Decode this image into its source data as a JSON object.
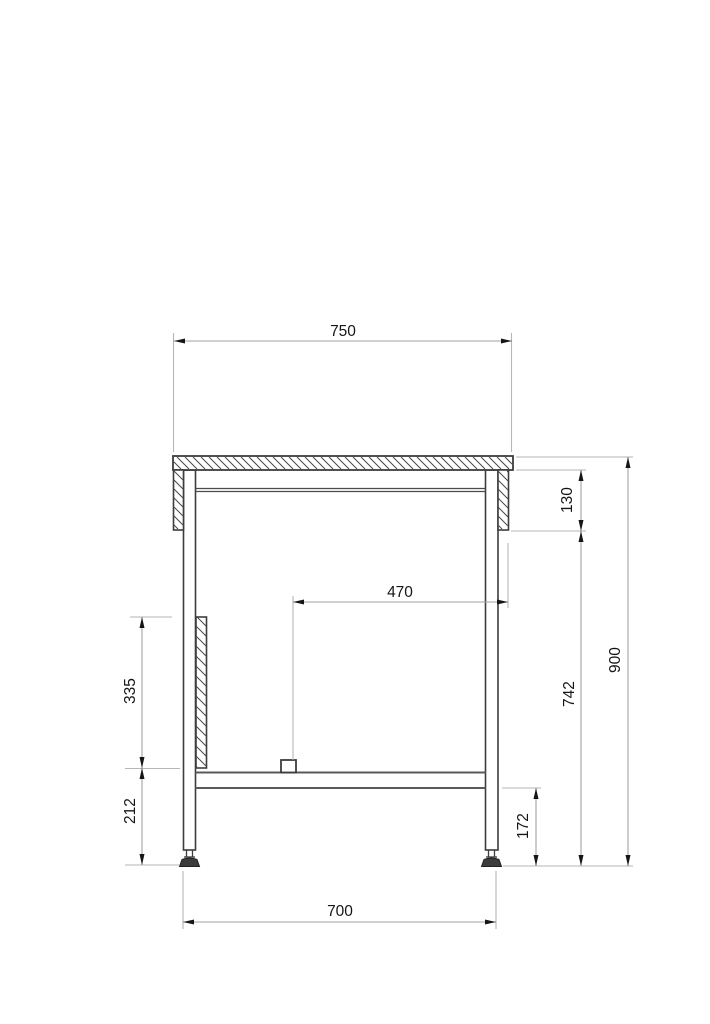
{
  "dimensions": {
    "top_width": {
      "value": "750"
    },
    "apron_height": {
      "value": "130"
    },
    "shelf_stop_span": {
      "value": "470"
    },
    "side_panel_height": {
      "value": "335"
    },
    "lower_leg_height": {
      "value": "212"
    },
    "shelf_clearance": {
      "value": "172"
    },
    "under_top_height": {
      "value": "742"
    },
    "overall_height": {
      "value": "900"
    },
    "leg_outer_span": {
      "value": "700"
    }
  }
}
